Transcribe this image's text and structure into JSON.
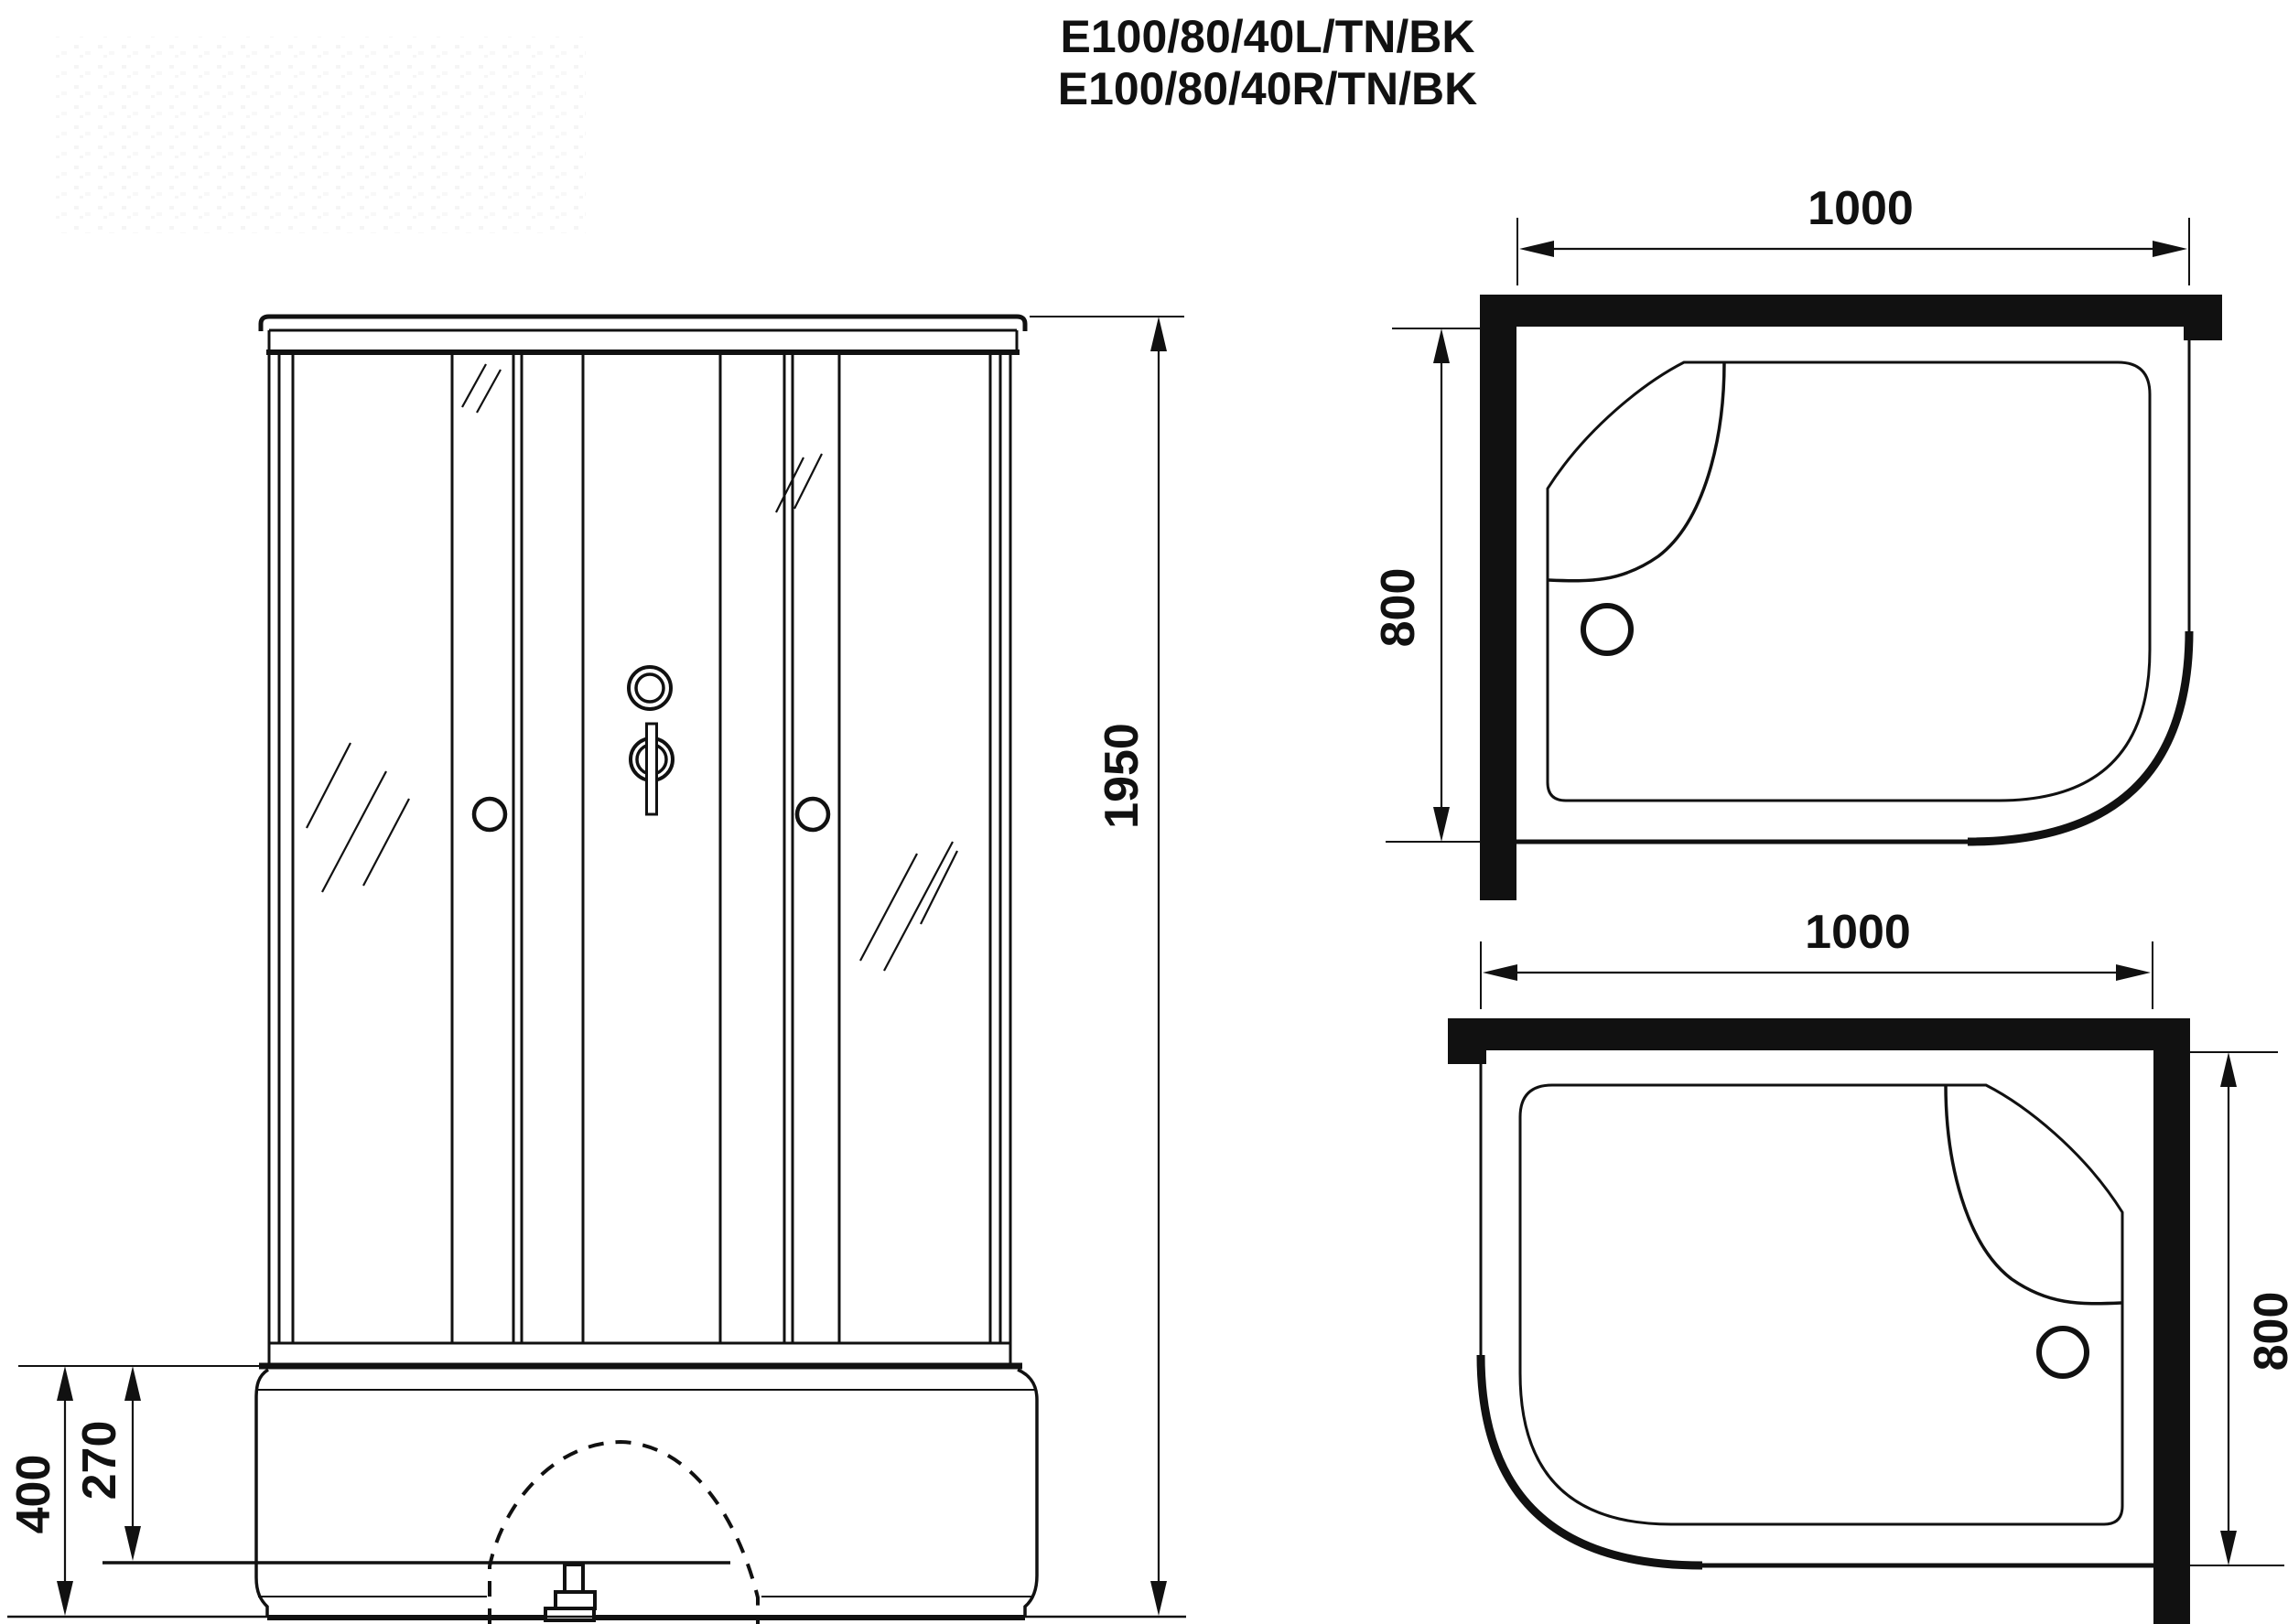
{
  "drawing": {
    "background": "#ffffff",
    "line_color": "#111111",
    "title": {
      "line1": "E100/80/40L/TN/BK",
      "line2": "E100/80/40R/TN/BK"
    },
    "front_view": {
      "overall_height": "1950",
      "tray_height": "400",
      "tray_inner_height": "270"
    },
    "top_view_left": {
      "width": "1000",
      "depth": "800"
    },
    "top_view_right": {
      "width": "1000",
      "depth": "800"
    }
  }
}
